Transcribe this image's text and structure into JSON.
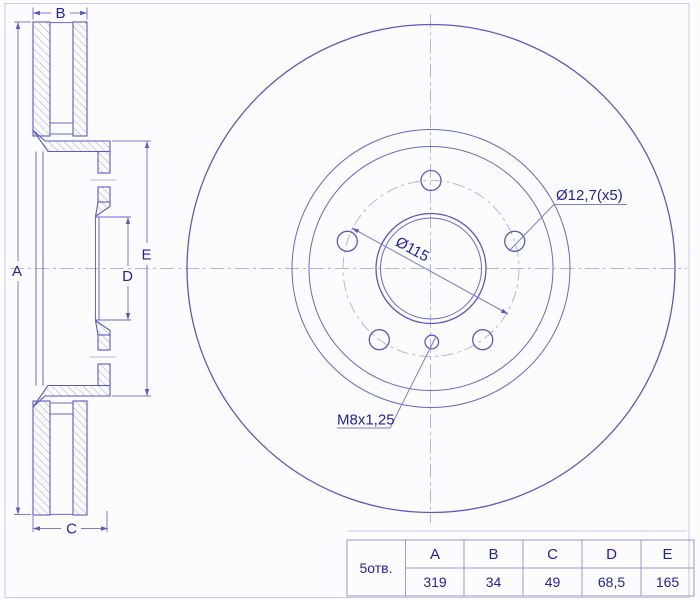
{
  "dimension_labels": {
    "A": "A",
    "B": "B",
    "C": "C",
    "D": "D",
    "E": "E"
  },
  "annotations": {
    "bolt_hole_dia": "Ø12,7(x5)",
    "bolt_circle_dia": "Ø115",
    "thread_spec": "M8x1,25"
  },
  "spec_table": {
    "row_header": "5отв.",
    "columns": [
      "A",
      "B",
      "C",
      "D",
      "E"
    ],
    "values": [
      "319",
      "34",
      "49",
      "68,5",
      "165"
    ]
  },
  "dimensions_mm": {
    "A": "319",
    "B": "34",
    "C": "49",
    "D": "68,5",
    "E": "165"
  },
  "colors": {
    "background": "#fcfcff",
    "outline": "#5a5ac2",
    "thin_line": "#6868c9",
    "dimension_line": "#7d7dce",
    "hatch": "#a2a2dd",
    "centerline": "#b6b6e2",
    "text": "#2222a2",
    "table_border": "#9a9ad2",
    "frame": "#c9c9ea"
  }
}
